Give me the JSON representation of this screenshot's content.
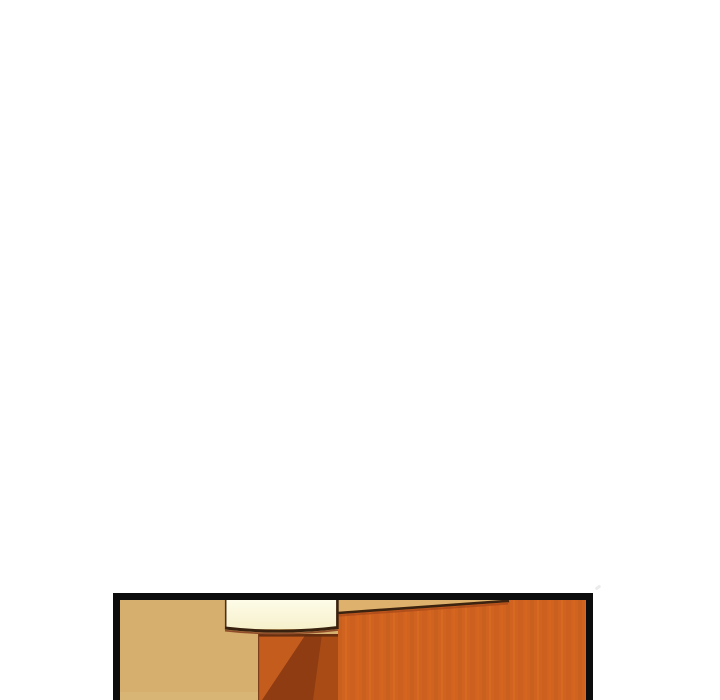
{
  "page": {
    "background_color": "#ffffff"
  },
  "comic_panel": {
    "alt": "Comic panel top edge: room corner with tan wall, pale cream slab and orange wooden wardrobe panels",
    "border_color": "#0c0c0c",
    "colors": {
      "wall": "#d6af6e",
      "floor_strip": "#d9b575",
      "wall_top_strip": "#deb26c",
      "panel_base": "#d0631f",
      "panel_grain_a": "#c45c1d",
      "panel_grain_b": "#dd6f24",
      "panel_grain_c": "#c95e1e",
      "panel_grain_d": "#d96b22",
      "panel_edge_dark": "#3c2310",
      "panel_edge_shadow": "#a8491a",
      "pillar_dark": "#8f3c12",
      "pillar_light": "#c45c1e",
      "pillar_mid": "#a84b15",
      "pillar_top_shadow": "#5f2c10",
      "pillar_left_edge": "#7c3f1c",
      "slab_top": "#fefce8",
      "slab_bottom": "#f6f0cc",
      "slab_outline": "#38220f",
      "slab_left_edge": "#4a331c",
      "slab_rim": "#8c4a26",
      "artifact_gray": "#d2d2d2"
    }
  }
}
